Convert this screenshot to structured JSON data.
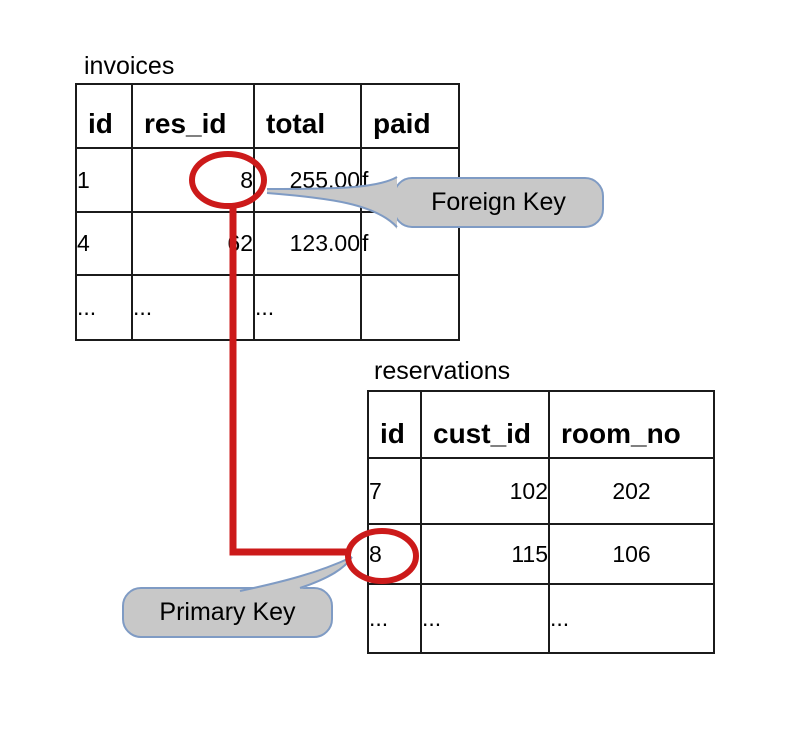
{
  "tables": {
    "invoices": {
      "title": "invoices",
      "columns": [
        "id",
        "res_id",
        "total",
        "paid"
      ],
      "rows": [
        [
          "1",
          "8",
          "255.00",
          "f"
        ],
        [
          "4",
          "62",
          "123.00",
          "f"
        ],
        [
          "...",
          "...",
          "...",
          ""
        ]
      ]
    },
    "reservations": {
      "title": "reservations",
      "columns": [
        "id",
        "cust_id",
        "room_no"
      ],
      "rows": [
        [
          "7",
          "102",
          "202"
        ],
        [
          "8",
          "115",
          "106"
        ],
        [
          "...",
          "...",
          "..."
        ]
      ]
    }
  },
  "callouts": {
    "foreign_key": {
      "label": "Foreign Key"
    },
    "primary_key": {
      "label": "Primary Key"
    }
  },
  "colors": {
    "annotation_red": "#cc1a1a",
    "callout_fill": "#c8c8c8",
    "callout_border": "#7f9bc4",
    "table_border": "#1b1b1b"
  }
}
